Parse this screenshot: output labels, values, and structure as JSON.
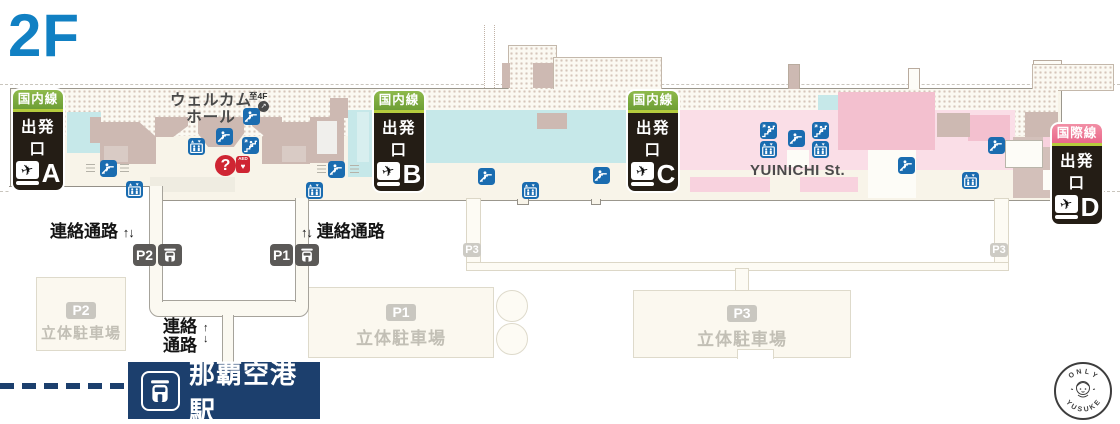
{
  "floor_label": "2F",
  "gates": [
    {
      "category": "国内線",
      "label": "出発口",
      "letter": "A"
    },
    {
      "category": "国内線",
      "label": "出発口",
      "letter": "B"
    },
    {
      "category": "国内線",
      "label": "出発口",
      "letter": "C"
    },
    {
      "category": "国際線",
      "label": "出発口",
      "letter": "D"
    }
  ],
  "labels": {
    "welcome_hall_line1": "ウェルカム",
    "welcome_hall_line2": "ホール",
    "to_4f": "至4F",
    "to_4f_arrow": "↗",
    "street": "YUINICHI St.",
    "passage_left": "連絡通路",
    "passage_right": "連絡通路",
    "updown_arrows": "↑↓",
    "passage_vert_line1": "連絡",
    "passage_vert_line2": "通路",
    "up_arrow": "↑",
    "down_arrow": "↓",
    "station_name": "那覇空港駅"
  },
  "connectors": {
    "p2_badge": "P2",
    "p1_badge": "P1",
    "p3_badge_left": "P3",
    "p3_badge_right": "P3"
  },
  "parking": [
    {
      "id": "P2",
      "name": "立体駐車場"
    },
    {
      "id": "P1",
      "name": "立体駐車場"
    },
    {
      "id": "P3",
      "name": "立体駐車場"
    }
  ],
  "info": {
    "question": "?",
    "aed": "AED",
    "aed_heart": "♥"
  },
  "stamp": {
    "top": "ONLY",
    "bottom": "YUSUKE"
  },
  "icons": {
    "plane": "✈",
    "escalator": "escalator-pictogram",
    "elevator": "elevator-pictogram",
    "stairs": "stairs-pictogram",
    "monorail": "monorail-pictogram"
  },
  "colors": {
    "floor_blue": "#1180c3",
    "domestic_green": "#7fae3f",
    "international_pink": "#ee7f9d",
    "sign_black": "#241d15",
    "icon_blue": "#1a6cb0",
    "alert_red": "#cf2533",
    "station_navy": "#1c3f6d",
    "terminal_cream": "#f8f4e9",
    "shop_mauve": "#cdb9b2",
    "domestic_teal": "#c6e8e9",
    "international_light_pink": "#fadee7"
  }
}
